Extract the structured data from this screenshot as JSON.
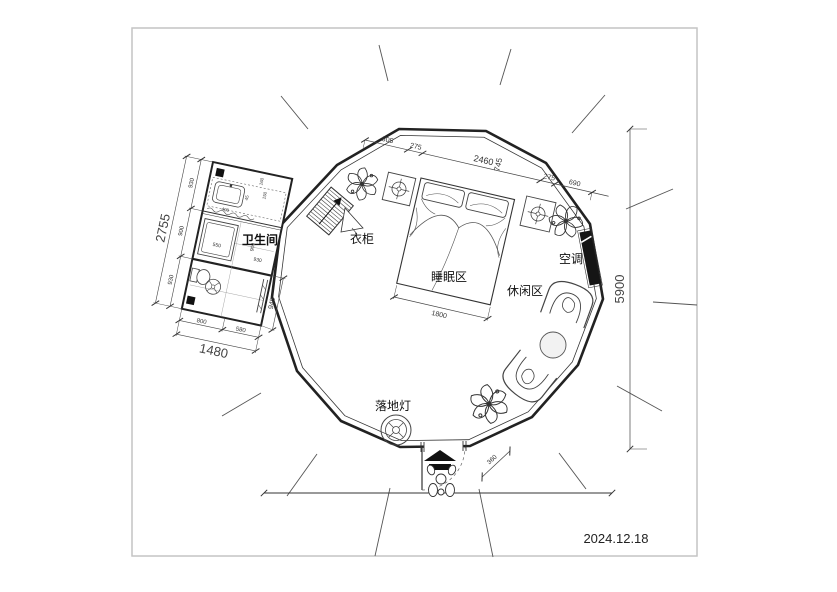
{
  "drawing": {
    "date": "2024.12.18",
    "labels": {
      "bathroom": "卫生间",
      "wardrobe": "衣柜",
      "sleeping_area": "睡眠区",
      "air_conditioner": "空调",
      "leisure_area": "休闲区",
      "floor_lamp": "落地灯"
    },
    "dims": {
      "top": {
        "a805": "805",
        "a275": "275",
        "a2460": "2460",
        "a745": "745",
        "b275": "275",
        "b690": "690"
      },
      "right_total": "5900",
      "bed_width": "1800",
      "entry_side": "360",
      "bath": {
        "left_total": "2755",
        "left_seg1": "930",
        "left_seg2": "900",
        "left_seg3": "930",
        "bottom_seg1": "800",
        "bottom_seg2": "580",
        "bottom_total": "1480",
        "right_seg": "945",
        "shower": "550",
        "sink": "400",
        "tiny1": "160",
        "tiny2": "150",
        "tiny3": "45",
        "mid_height": "900",
        "mid_width": "930"
      }
    }
  }
}
